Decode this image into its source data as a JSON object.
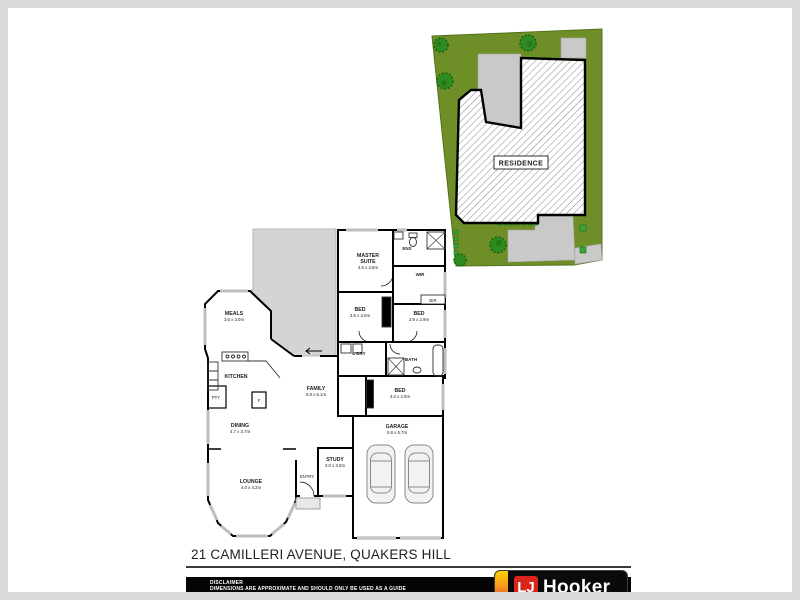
{
  "page": {
    "address": "21 CAMILLERI AVENUE, QUAKERS HILL"
  },
  "site_plan": {
    "residence_label": "RESIDENCE",
    "lot_color": "#6e8f28",
    "tree_color": "#2f8b1f",
    "driveway_color": "#c9c9c9"
  },
  "floor_plan": {
    "rooms": {
      "master": {
        "name_line1": "MASTER",
        "name_line2": "SUITE",
        "dims": "4.6 x 3.8m"
      },
      "ens": {
        "name": "ENS"
      },
      "wir": {
        "name": "WIR"
      },
      "bir": {
        "name": "BIR"
      },
      "bed2": {
        "name": "BED",
        "dims": "3.5 x 3.0m"
      },
      "bed3": {
        "name": "BED",
        "dims": "2.9 x 2.9m"
      },
      "ldry": {
        "name": "L'DRY"
      },
      "bath": {
        "name": "BATH"
      },
      "bed4": {
        "name": "BED",
        "dims": "4.0 x 2.9m"
      },
      "meals": {
        "name": "MEALS",
        "dims": "3.5 x 3.0m"
      },
      "kitchen": {
        "name": "KITCHEN"
      },
      "pantry": {
        "name": "PTY"
      },
      "fridge": {
        "name": "F"
      },
      "family": {
        "name": "FAMILY",
        "dims": "5.9 x 5.1m"
      },
      "dining": {
        "name": "DINING",
        "dims": "4.7 x 3.7m"
      },
      "study": {
        "name": "STUDY",
        "dims": "3.0 x 3.0m"
      },
      "entry": {
        "name": "ENTRY"
      },
      "lounge": {
        "name": "LOUNGE",
        "dims": "4.0 x 4.2m"
      },
      "garage": {
        "name": "GARAGE",
        "dims": "5.8 x 5.7m"
      }
    }
  },
  "footer": {
    "disclaimer_title": "DISCLAIMER",
    "disclaimer_line1": "DIMENSIONS ARE APPROXIMATE AND SHOULD ONLY BE USED AS A GUIDE",
    "disclaimer_line2": "THEY ARE NOT TO SCALE AND NO LIABILITY WILL BE ACCEPTED.",
    "logo": {
      "lj": "LJ",
      "hooker": "Hooker",
      "brand_red": "#d9251c",
      "stripe_yellow": "#ffd400",
      "stripe_orange": "#f7941d"
    }
  }
}
